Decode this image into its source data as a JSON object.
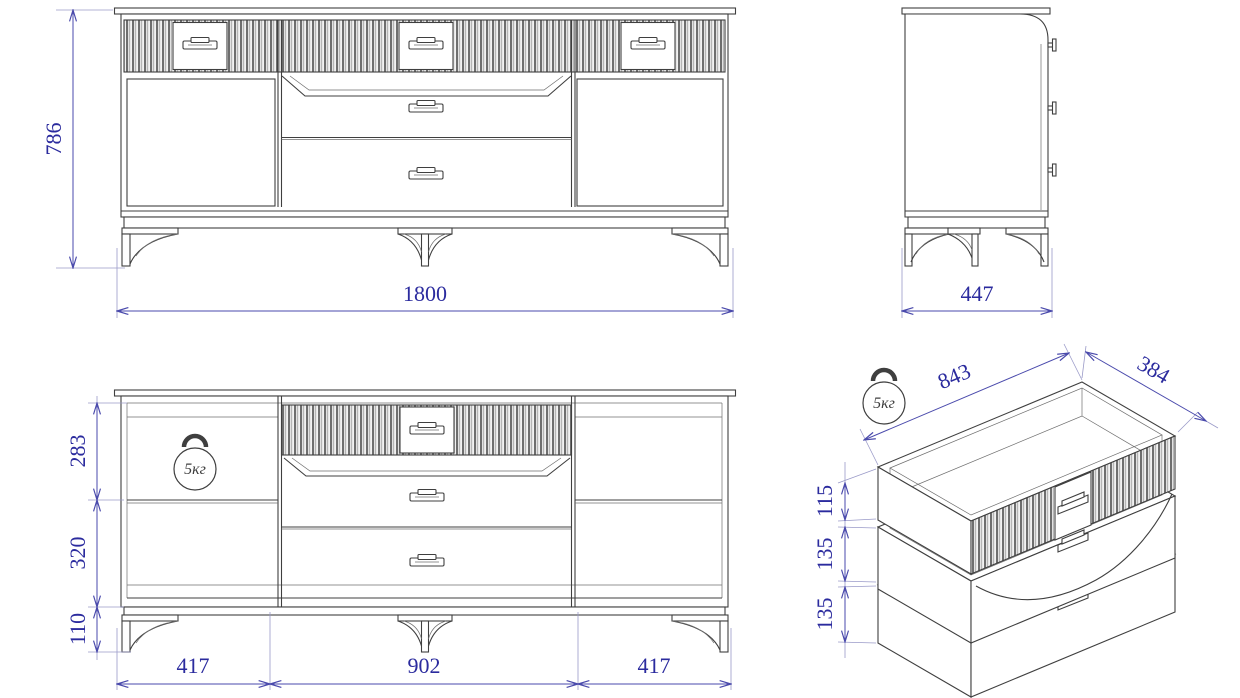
{
  "views": {
    "front": {
      "height": "786",
      "width": "1800"
    },
    "side": {
      "depth": "447"
    },
    "interior_front": {
      "upper_compartment_height": "283",
      "lower_compartment_height": "320",
      "leg_height": "110",
      "left_section_width": "417",
      "center_section_width": "902",
      "right_section_width": "417",
      "max_load": "5кг"
    },
    "drawers_iso": {
      "drawer_unit_width": "843",
      "drawer_unit_depth": "384",
      "top_drawer_height": "115",
      "middle_drawer_height": "135",
      "bottom_drawer_height": "135",
      "max_load": "5кг"
    }
  },
  "colors": {
    "dimension_text": "#2b2b9e",
    "dimension_line": "#4a4aac",
    "extension_line": "#9a9ac8",
    "geometry_line": "#3f3f3f",
    "background": "#ffffff"
  }
}
